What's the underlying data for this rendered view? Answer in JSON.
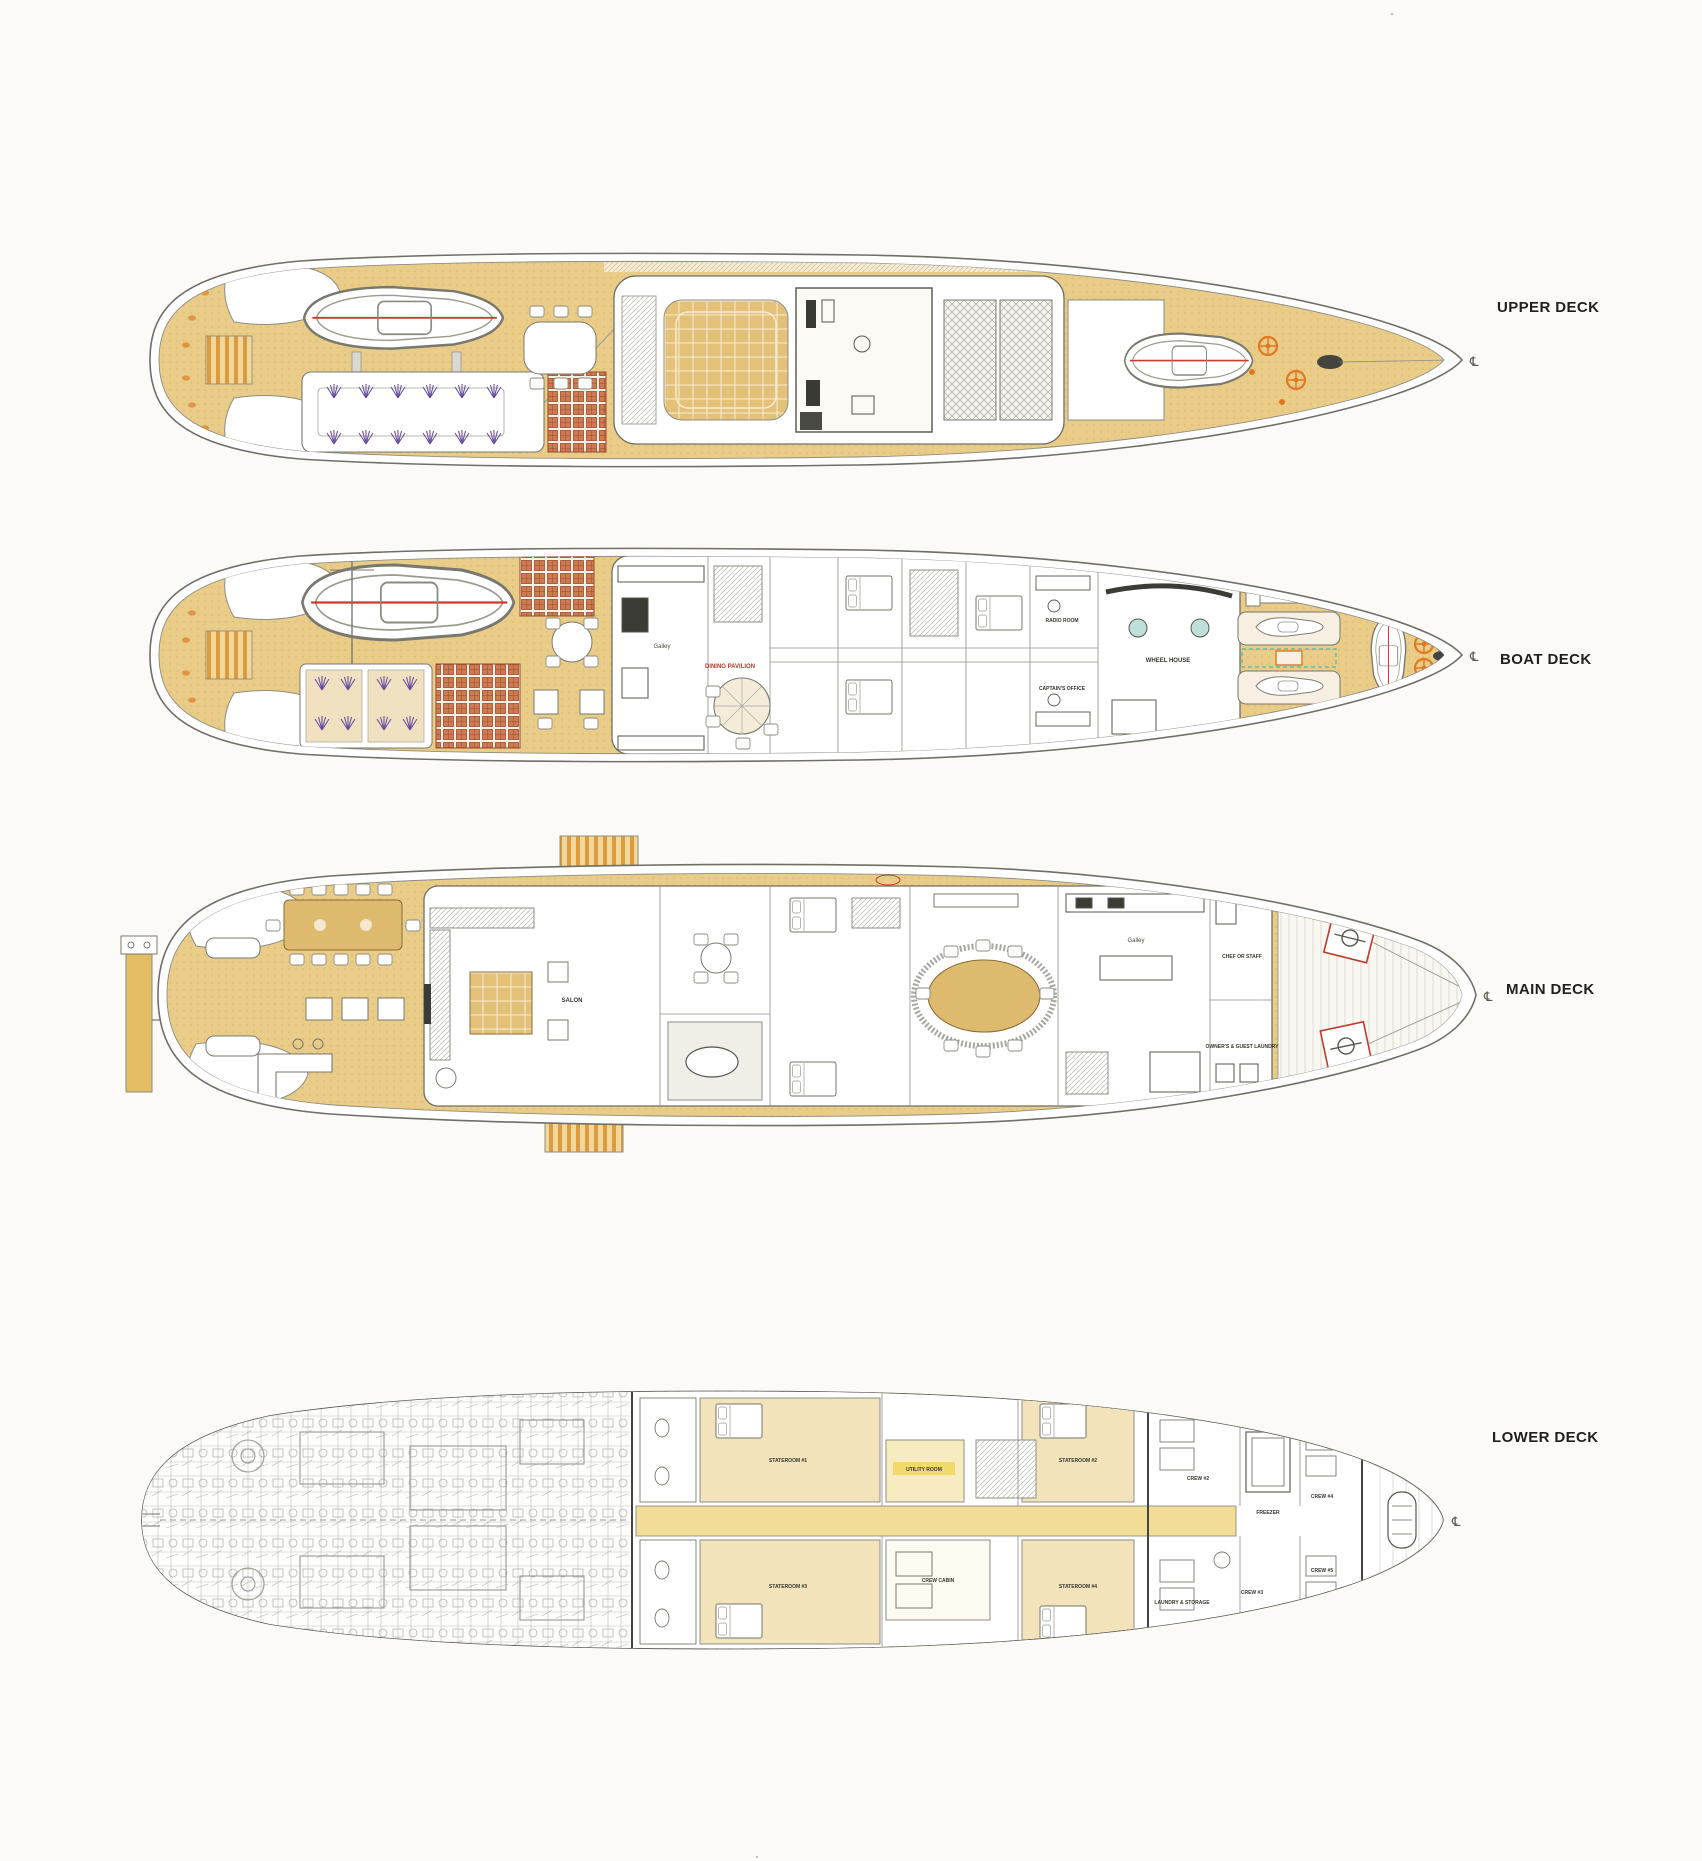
{
  "page": {
    "background": "#fbfaf6",
    "type": "scanned yacht deck plan drawing"
  },
  "colors": {
    "paper": "#fbfaf6",
    "deck_tan": "#e9cc88",
    "deck_tan_dark": "#d8b46a",
    "wood": "#ddba6e",
    "corridor_yellow": "#f3dc96",
    "highlight_yellow": "#f2d96b",
    "lattice_orange": "#cd7a50",
    "stair_orange": "#dc9b3f",
    "accent_orange": "#e07820",
    "accent_red": "#c03a2a",
    "accent_purple": "#6a4fa0",
    "accent_teal": "#49b8ae",
    "accent_magenta": "#b05ab0",
    "line_gray": "#6f6f68",
    "engine_gray": "#a9a9a2"
  },
  "symbols": {
    "centerline": "℄"
  },
  "decks": {
    "upper": {
      "title": "UPPER DECK"
    },
    "boat": {
      "title": "BOAT DECK",
      "rooms": {
        "galley": "Galley",
        "dining_pavilion": "DINING PAVILION",
        "wheel_house": "WHEEL HOUSE",
        "radio_room": "RADIO ROOM",
        "captains_office": "CAPTAIN'S OFFICE"
      }
    },
    "main": {
      "title": "MAIN DECK",
      "rooms": {
        "salon": "SALON",
        "galley": "Galley",
        "chef_or_staff": "CHEF OR STAFF",
        "owners_guest_laundry": "OWNER'S & GUEST LAUNDRY"
      }
    },
    "lower": {
      "title": "LOWER DECK",
      "rooms": {
        "stateroom_1": "STATEROOM #1",
        "stateroom_2": "STATEROOM #2",
        "stateroom_3": "STATEROOM #3",
        "stateroom_4": "STATEROOM #4",
        "utility_room": "UTILITY ROOM",
        "crew_cabin": "CREW CABIN",
        "crew_2": "CREW #2",
        "crew_3": "CREW #3",
        "crew_4": "CREW #4",
        "crew_5": "CREW #5",
        "freezer": "FREEZER",
        "laundry_storage": "LAUNDRY & STORAGE"
      }
    }
  }
}
